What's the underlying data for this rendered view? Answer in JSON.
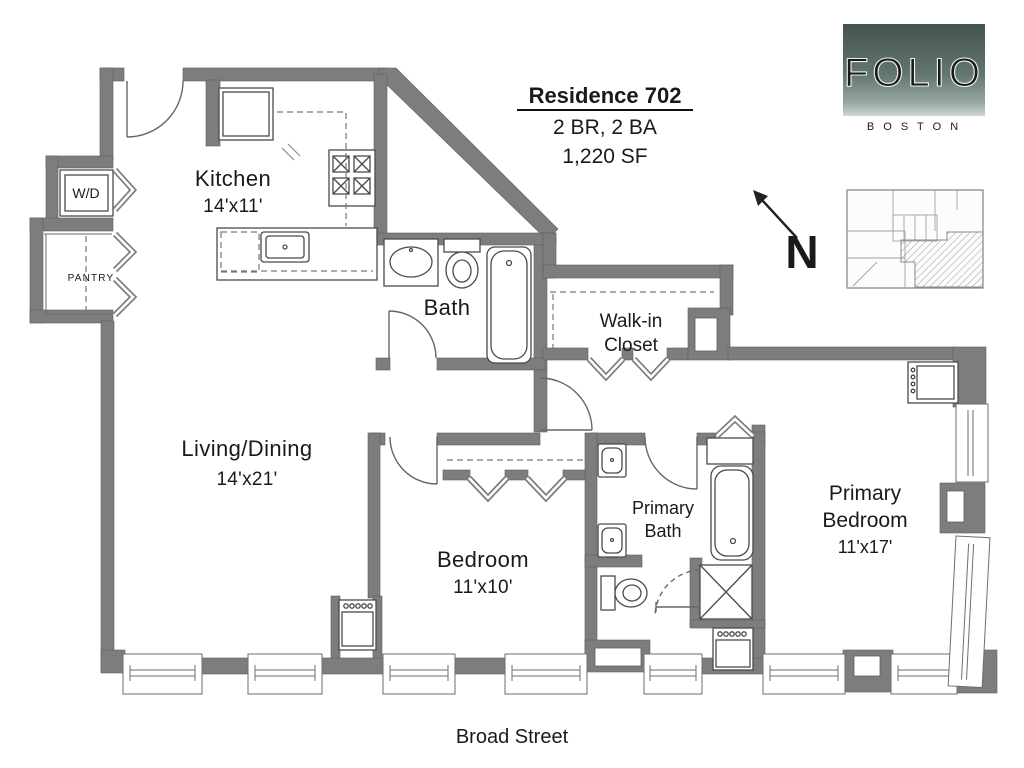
{
  "title": {
    "residence": "Residence 702",
    "specs": "2 BR, 2 BA",
    "area": "1,220 SF"
  },
  "logo": {
    "brand": "FOLIO",
    "city": "B O S T O N"
  },
  "compass": {
    "north": "N"
  },
  "street": {
    "label": "Broad Street"
  },
  "rooms": {
    "kitchen": {
      "name": "Kitchen",
      "dims": "14'x11'"
    },
    "living_dining": {
      "name": "Living/Dining",
      "dims": "14'x21'"
    },
    "bath": {
      "name": "Bath"
    },
    "walk_in_closet": {
      "line1": "Walk-in",
      "line2": "Closet"
    },
    "bedroom": {
      "name": "Bedroom",
      "dims": "11'x10'"
    },
    "primary_bath": {
      "line1": "Primary",
      "line2": "Bath"
    },
    "primary_bedroom": {
      "line1": "Primary",
      "line2": "Bedroom",
      "dims": "11'x17'"
    },
    "washer_dryer": {
      "name": "W/D"
    },
    "pantry": {
      "name": "PANTRY"
    }
  },
  "colors": {
    "wall": "#7d7d7d",
    "fixture_line": "#4a4a4a",
    "logo_green_dark": "#44534e",
    "logo_green_light": "#cfd8d3",
    "text": "#1a1a1a"
  }
}
